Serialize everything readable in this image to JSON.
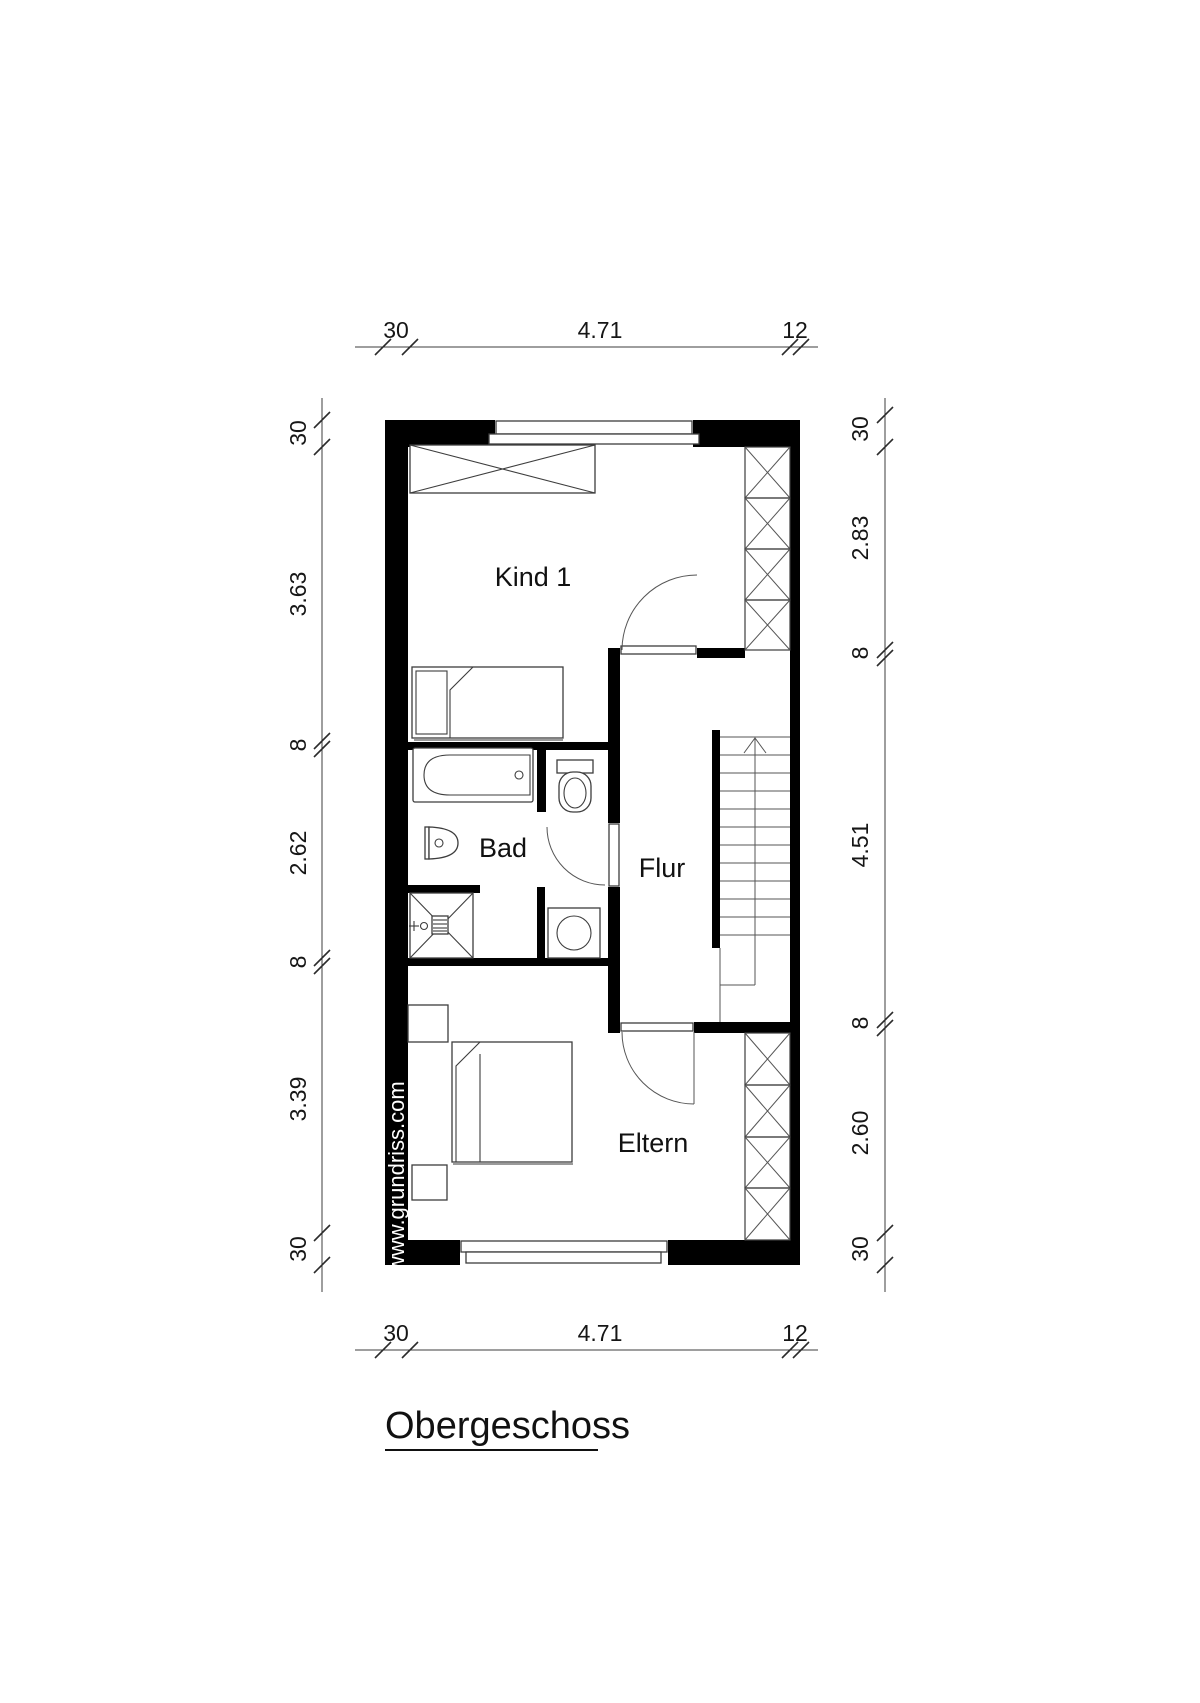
{
  "title": {
    "text": "Obergeschoss"
  },
  "watermark": {
    "text": "www.grundriss.com"
  },
  "floor_plan": {
    "rooms": {
      "kind1": {
        "label": "Kind 1"
      },
      "bad": {
        "label": "Bad"
      },
      "flur": {
        "label": "Flur"
      },
      "eltern": {
        "label": "Eltern"
      }
    },
    "stairs": {
      "direction": "up"
    },
    "furniture_icons": [
      "wardrobe-icon",
      "single-bed-icon",
      "bathtub-icon",
      "toilet-icon",
      "sink-icon",
      "shower-icon",
      "washing-machine-icon",
      "staircase-icon",
      "double-bed-icon",
      "nightstand-icon",
      "closet-hatch-icon",
      "window-icon",
      "door-swing-icon"
    ]
  },
  "dimensions": {
    "top": {
      "values": [
        "30",
        "4.71",
        "12"
      ]
    },
    "bottom": {
      "values": [
        "30",
        "4.71",
        "12"
      ]
    },
    "left": {
      "values": [
        "30",
        "3.63",
        "8",
        "2.62",
        "8",
        "3.39",
        "30"
      ]
    },
    "right": {
      "values": [
        "30",
        "2.83",
        "8",
        "4.51",
        "8",
        "2.60",
        "30"
      ]
    }
  },
  "colors": {
    "wall": "#000000",
    "line": "#3d3d3d",
    "background": "#ffffff",
    "watermark_text": "#ffffff"
  }
}
